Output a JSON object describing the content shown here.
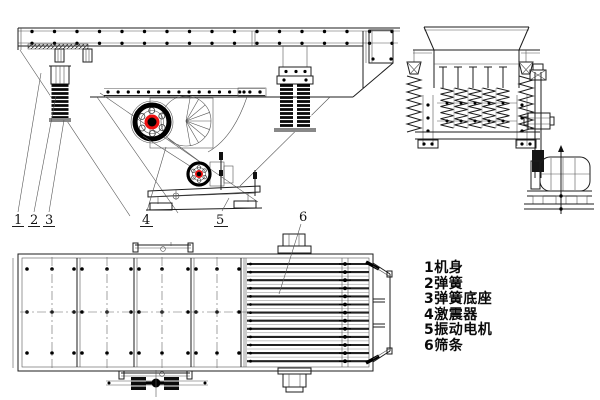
{
  "drawing": {
    "type": "engineering-three-view-drawing",
    "subject": "vibrating feeder (side view, end view, plan view)",
    "colors": {
      "background": "#ffffff",
      "line": "#1c1c1c",
      "accent_red": "#ee1111",
      "spring_black": "#0a0a0a"
    },
    "callouts": [
      "1",
      "2",
      "3",
      "4",
      "5",
      "6"
    ],
    "legend": {
      "items": [
        {
          "label": "1机身"
        },
        {
          "label": "2弹簧"
        },
        {
          "label": "3弹簧底座"
        },
        {
          "label": "4激震器"
        },
        {
          "label": "5振动电机"
        },
        {
          "label": "6筛条"
        }
      ]
    }
  }
}
